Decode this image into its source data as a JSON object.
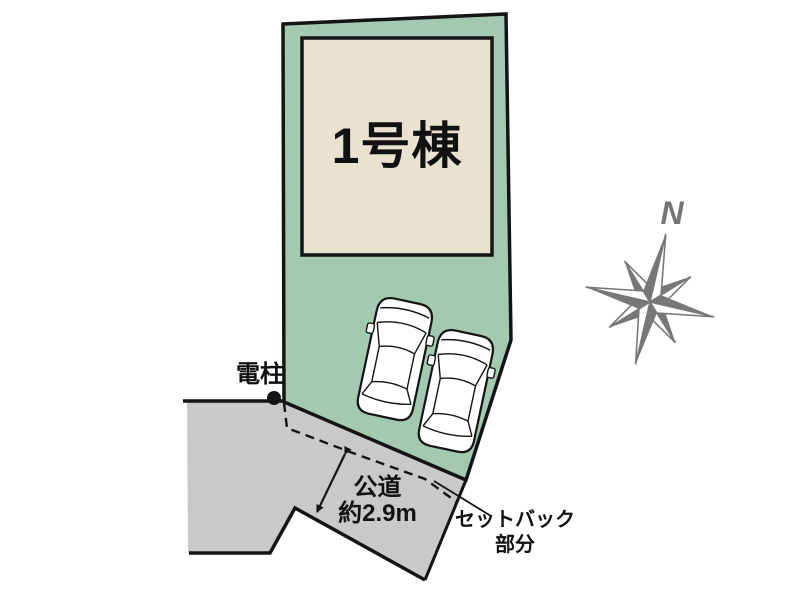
{
  "plan": {
    "building": {
      "label": "1号棟"
    },
    "pole": {
      "label": "電柱"
    },
    "road": {
      "label": "公道",
      "width_label": "約2.9m"
    },
    "setback": {
      "label_line1": "セットバック",
      "label_line2": "部分"
    },
    "compass": {
      "label": "N"
    }
  },
  "colors": {
    "plot_green": "#a3c9b1",
    "building_beige": "#e9e2d1",
    "road_gray": "#c9c9c9",
    "outline": "#141414",
    "compass_gray": "#777777",
    "car_fill": "#ffffff"
  }
}
